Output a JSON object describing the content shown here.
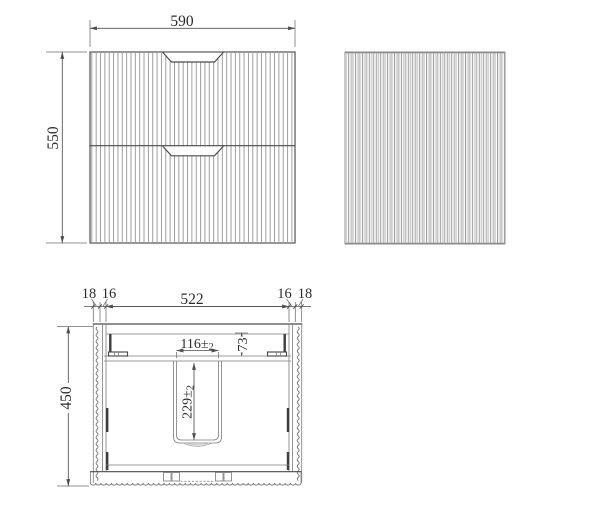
{
  "front_view": {
    "width_dim": "590",
    "height_dim": "550"
  },
  "section_view": {
    "depth_dim": "450",
    "left_outer_wall_dim": "18",
    "left_inner_panel_dim": "16",
    "inner_width_dim": "522",
    "right_inner_panel_dim": "16",
    "right_outer_wall_dim": "18",
    "cutout_width_main": "116±",
    "cutout_width_tol": "2",
    "cutout_offset_dim": "73",
    "cutout_depth_main": "229±",
    "cutout_depth_tol": "2"
  },
  "colors": {
    "background": "#ffffff",
    "outline": "#4a4a4a",
    "dimension_line": "#4f4f4f",
    "text": "#2b2b2b",
    "flute_front": "#9a9a9a",
    "flute_side_dark": "#999999",
    "flute_side_light": "#cccccc"
  }
}
